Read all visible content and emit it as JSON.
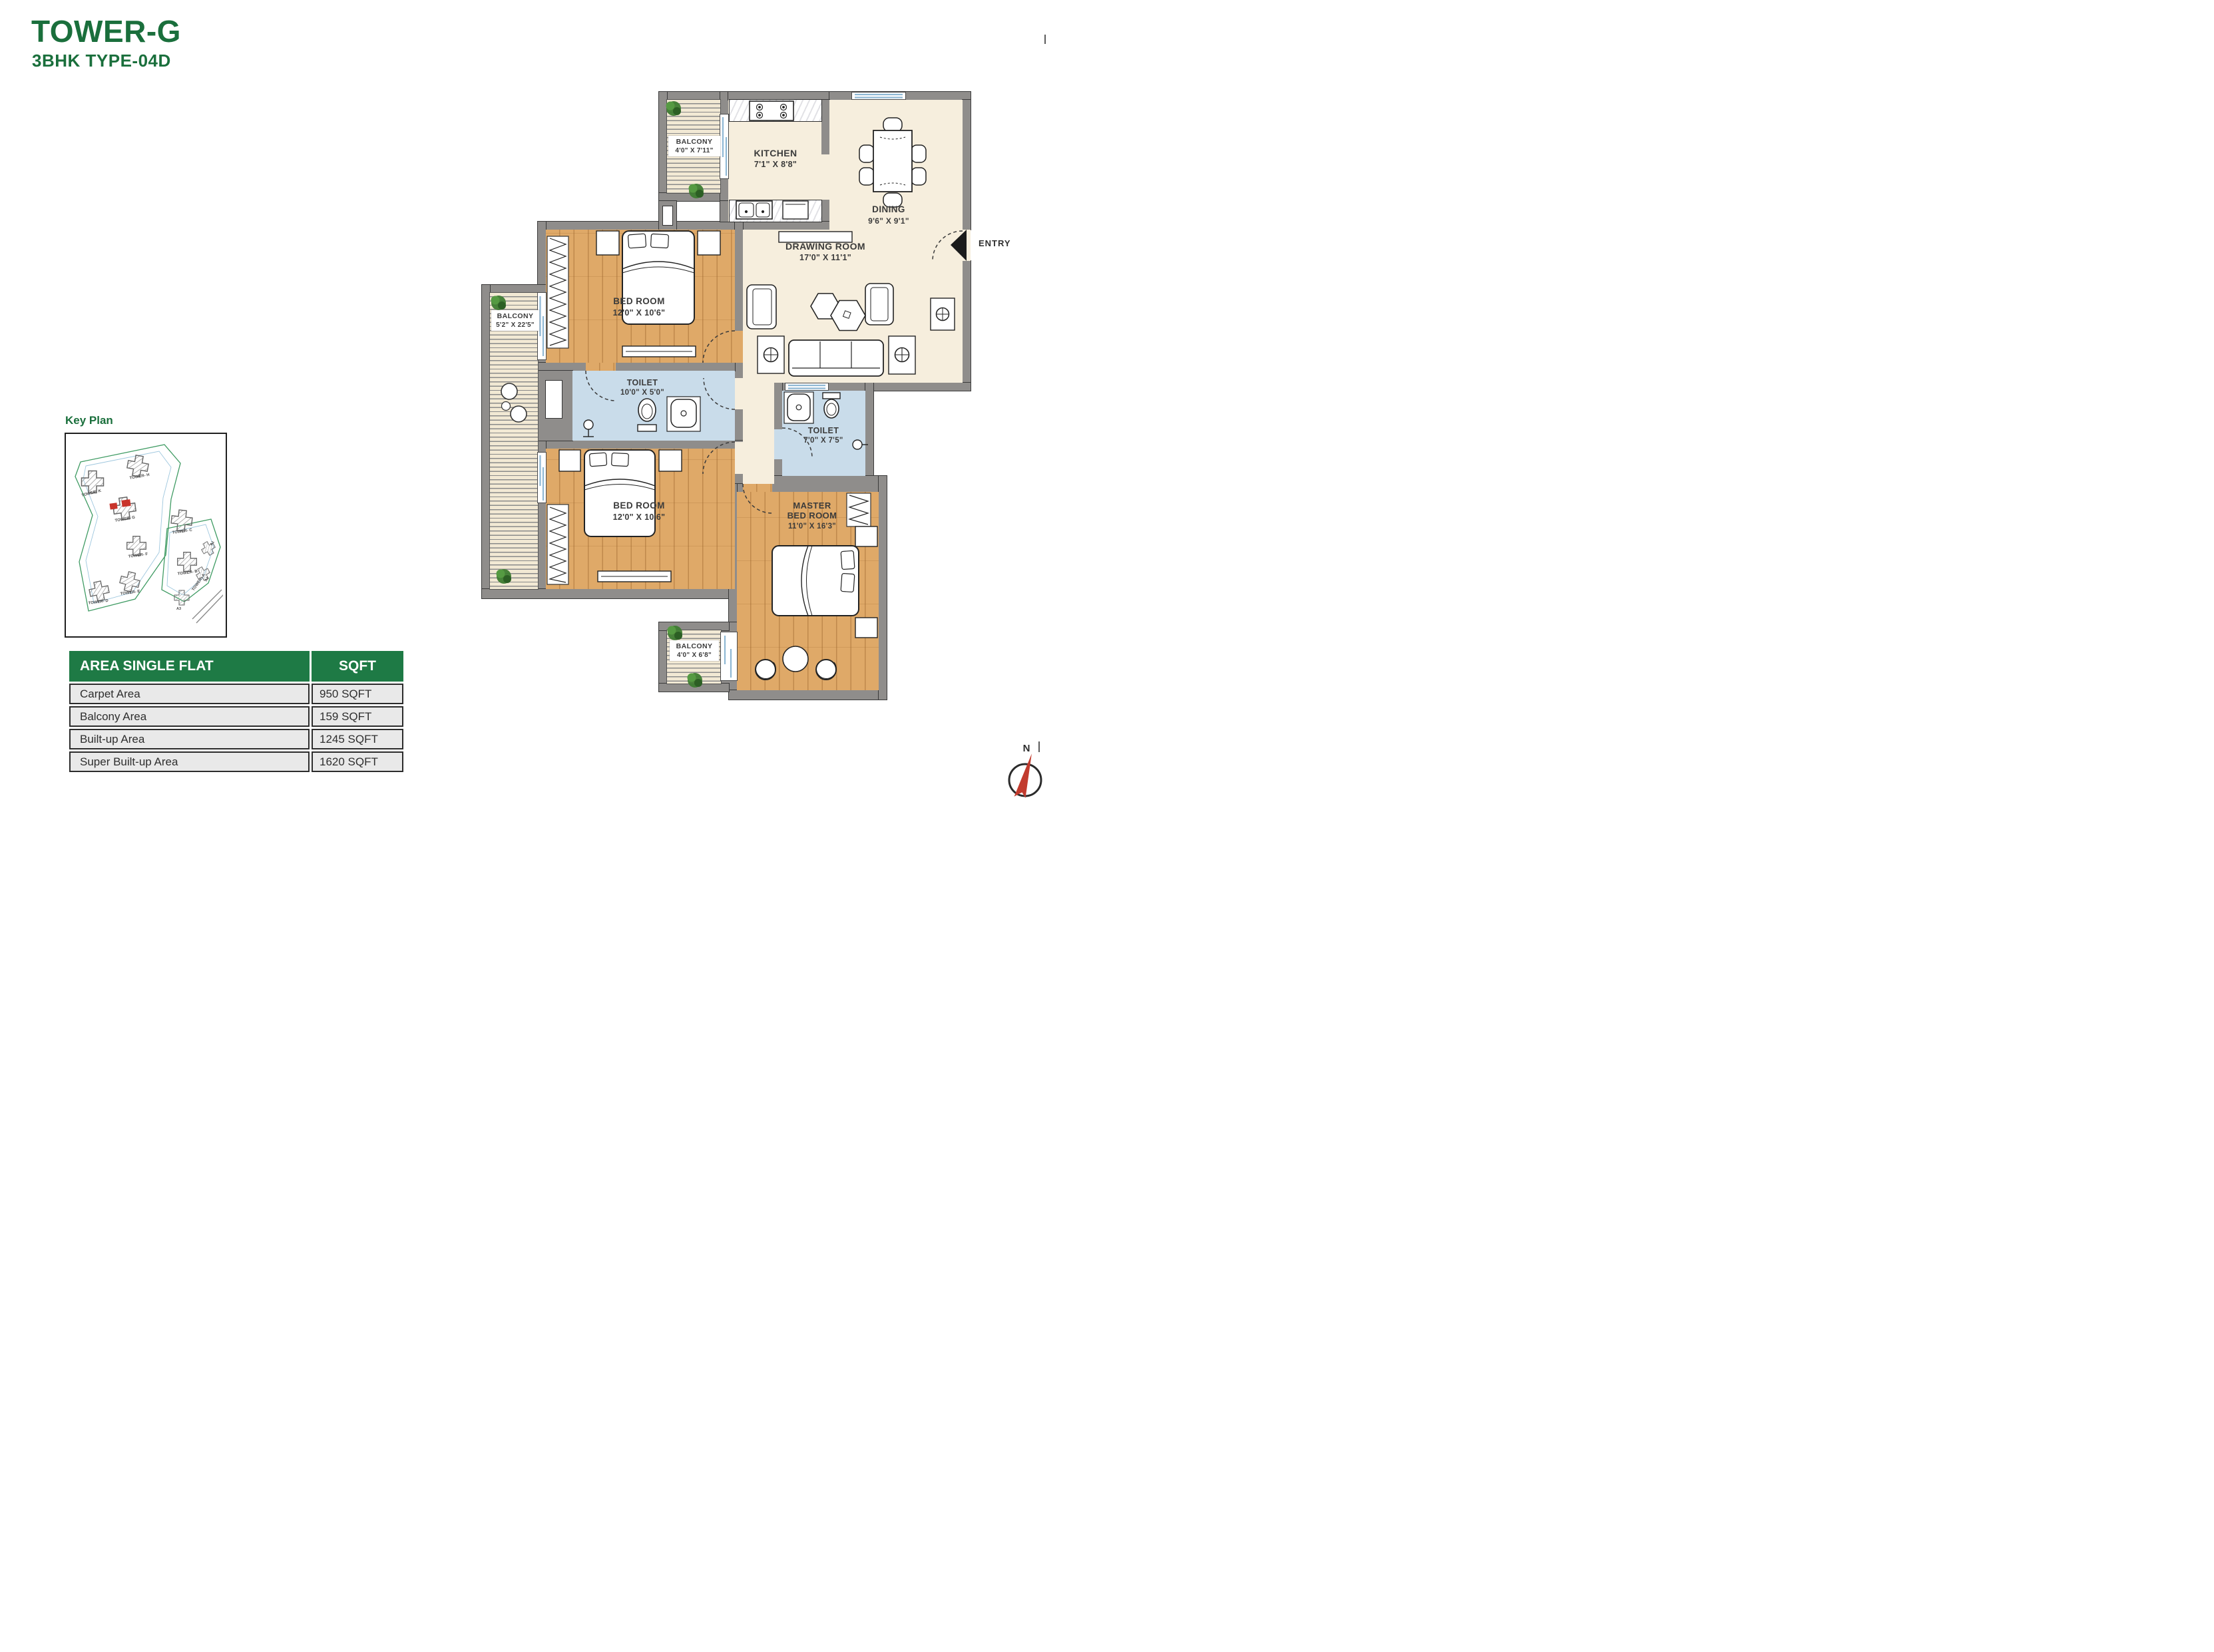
{
  "page": {
    "title": "TOWER-G",
    "subtitle": "3BHK TYPE-04D",
    "key_plan_label": "Key Plan",
    "entry_label": "ENTRY",
    "north_label": "N"
  },
  "colors": {
    "brand_green": "#1a6f3c",
    "table_header_green": "#1e7a45",
    "highlight_red": "#c9342b",
    "wall_gray": "#8f8d8b",
    "floor_cream": "#f6eedd",
    "floor_wood": "#dfa968",
    "floor_toilet_blue": "#c9dcea"
  },
  "key_plan": {
    "towers": [
      "TOWER- K",
      "TOWER- H",
      "TOWER- G",
      "TOWER- F",
      "TOWER- E",
      "TOWER- D",
      "TOWER- C",
      "TOWER- B",
      "TOWER- A",
      "A1",
      "A2",
      "A3"
    ]
  },
  "area_table": {
    "header": {
      "name": "AREA SINGLE FLAT",
      "unit": "SQFT"
    },
    "rows": [
      {
        "name": "Carpet Area",
        "value": "950 SQFT"
      },
      {
        "name": "Balcony Area",
        "value": "159 SQFT"
      },
      {
        "name": "Built-up Area",
        "value": "1245 SQFT"
      },
      {
        "name": "Super Built-up Area",
        "value": "1620 SQFT"
      }
    ]
  },
  "rooms": [
    {
      "name": "BALCONY",
      "dims": "4'0\" X 7'11\""
    },
    {
      "name": "KITCHEN",
      "dims": "7'1\" X 8'8\""
    },
    {
      "name": "DINING",
      "dims": "9'6\" X 9'1\""
    },
    {
      "name": "DRAWING ROOM",
      "dims": "17'0\" X 11'1\""
    },
    {
      "name": "BED ROOM",
      "dims": "12'0\" X 10'6\""
    },
    {
      "name": "TOILET",
      "dims": "10'0\" X 5'0\""
    },
    {
      "name": "BALCONY",
      "dims": "5'2\" X 22'5\""
    },
    {
      "name": "BED ROOM",
      "dims": "12'0\" X 10'6\""
    },
    {
      "name": "TOILET",
      "dims": "7'0\" X 7'5\""
    },
    {
      "name": "MASTER BED ROOM",
      "dims": "11'0\" X 16'3\""
    },
    {
      "name": "BALCONY",
      "dims": "4'0\" X 6'8\""
    }
  ]
}
